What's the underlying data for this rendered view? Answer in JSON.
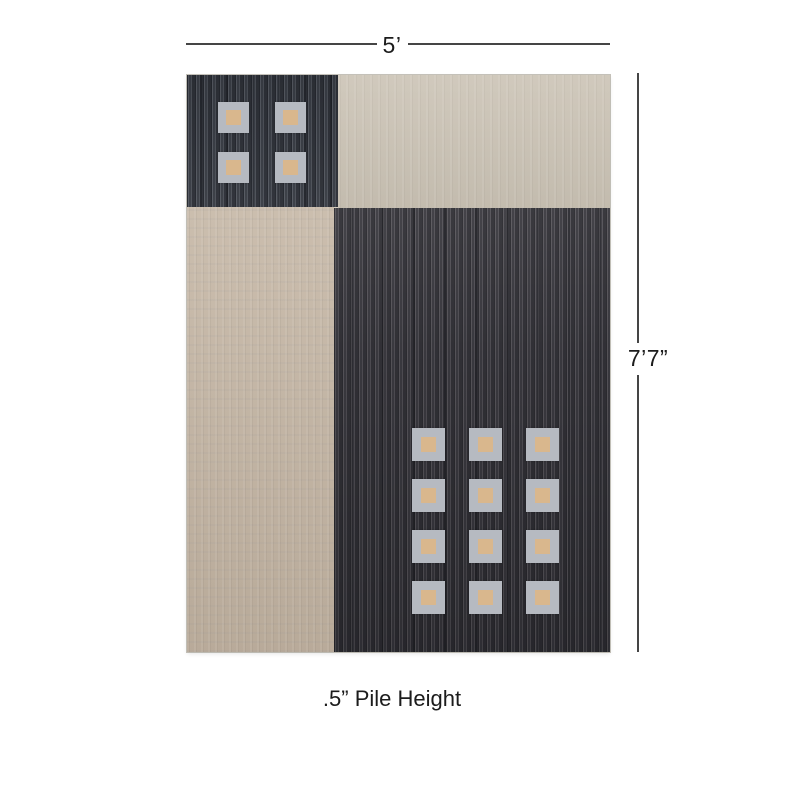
{
  "annotations": {
    "width_label": "5’",
    "height_label": "7’7”",
    "pile_height_label": ".5” Pile Height",
    "line_color": "#454545",
    "text_color": "#1c1c1c"
  },
  "rug": {
    "description": "color-block area rug with charcoal and beige panels and square motifs",
    "colors": {
      "charcoal_top_left": "#43474f",
      "charcoal_main": "#47454b",
      "beige_left": "#c4b5a3",
      "beige_top_right": "#cbc3b5",
      "square_outer_gray": "#b6bac1",
      "square_inner_tan": "#d9b78d",
      "edge_trim": "#d6cfc2",
      "line_color": "#454545",
      "text_color": "#1c1c1c"
    },
    "square_grids": [
      {
        "id": "top-left",
        "rows": 2,
        "cols": 2
      },
      {
        "id": "main",
        "rows": 4,
        "cols": 3
      }
    ]
  }
}
